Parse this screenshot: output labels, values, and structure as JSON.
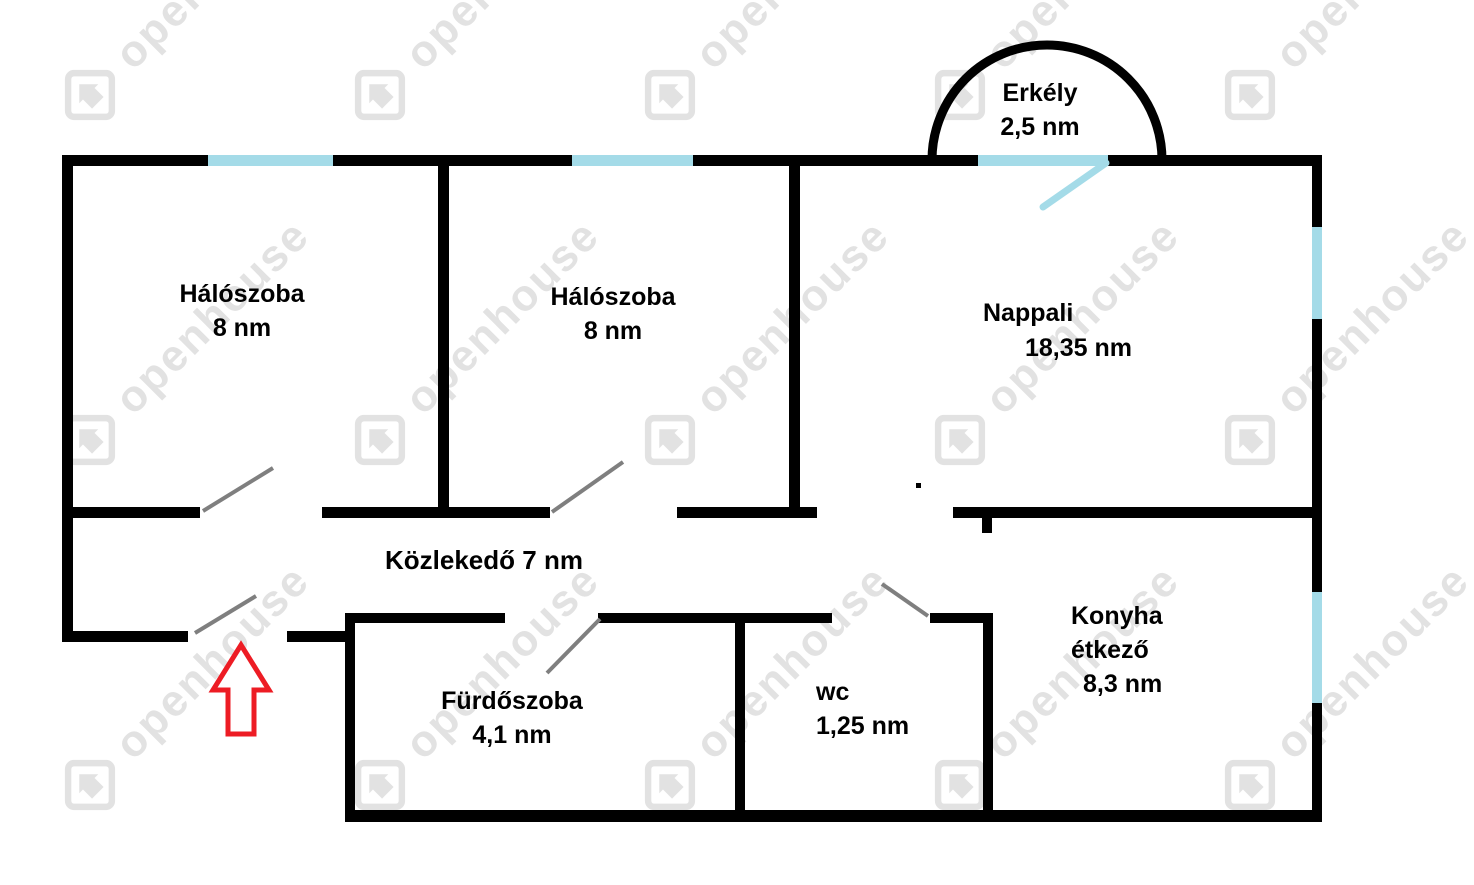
{
  "plan": {
    "rooms": {
      "bedroom1": {
        "name": "Hálószoba",
        "area": "8 nm"
      },
      "bedroom2": {
        "name": "Hálószoba",
        "area": "8 nm"
      },
      "living": {
        "name": "Nappali",
        "area": "18,35 nm"
      },
      "hallway": {
        "name": "Közlekedő",
        "area": "7 nm"
      },
      "bathroom": {
        "name": "Fürdőszoba",
        "area": "4,1 nm"
      },
      "wc": {
        "name": "wc",
        "area": "1,25 nm"
      },
      "kitchen": {
        "name_line1": "Konyha",
        "name_line2": "étkező",
        "area": "8,3 nm"
      },
      "balcony": {
        "name": "Erkély",
        "area": "2,5 nm"
      }
    },
    "colors": {
      "wall": "#000000",
      "window": "#a4dbe8",
      "door-swing": "#7f7f7f",
      "arrow": "#ed1c24",
      "watermark": "#e2e2e2"
    }
  },
  "watermark": {
    "text": "openhouse"
  }
}
